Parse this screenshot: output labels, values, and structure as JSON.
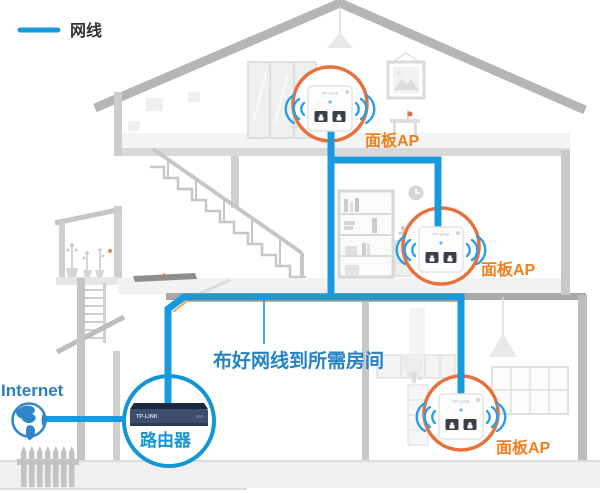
{
  "legend": {
    "label": "网线"
  },
  "internet": {
    "label": "Internet"
  },
  "router": {
    "label": "路由器",
    "brand": "TP-LINK"
  },
  "aps": {
    "brand": "TP-LINK",
    "top": {
      "label": "面板AP"
    },
    "middle": {
      "label": "面板AP"
    },
    "bottom": {
      "label": "面板AP"
    }
  },
  "note": {
    "text": "布好网线到所需房间"
  },
  "colors": {
    "cable": "#189ade",
    "router-circle": "#1496d4",
    "ap-circle": "#e8703c",
    "ap-label": "#f0801e",
    "note-text": "#2583c5",
    "internet-text": "#2b7fc0",
    "wifi": "#2b9fe4"
  }
}
